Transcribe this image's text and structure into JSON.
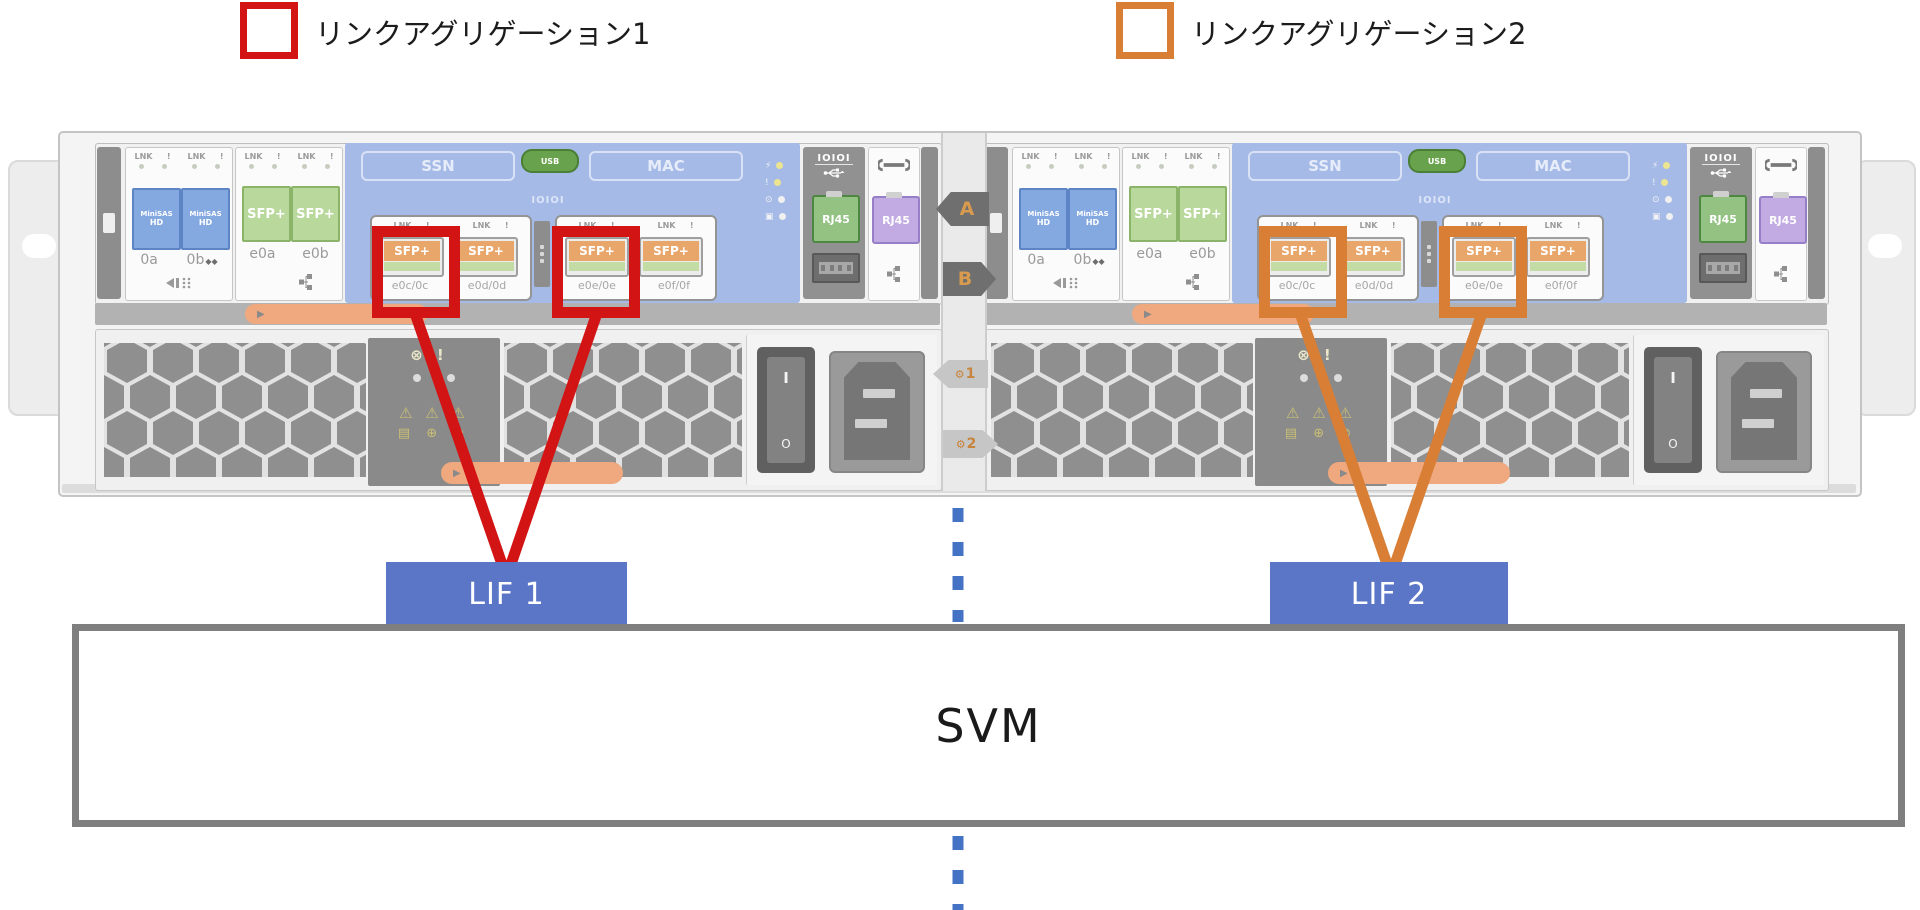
{
  "colors": {
    "link_aggregation_1": "#d21414",
    "link_aggregation_2": "#d97e35",
    "lif_box": "#5b76c7",
    "svm_border": "#7f7f7f",
    "dotted_line": "#4472c4"
  },
  "legend": {
    "items": [
      {
        "label": "リンクアグリゲーション1",
        "color": "#d21414"
      },
      {
        "label": "リンクアグリゲーション2",
        "color": "#d97e35"
      }
    ]
  },
  "chassis": {
    "divider_tags": {
      "top": "A",
      "bottom": "B",
      "gear_icon": "⚙",
      "psu1": "1",
      "psu2": "2"
    },
    "controllers": [
      {
        "link_label": "LNK",
        "attn_label": "!",
        "sas_module": {
          "card_label_top": "MiniSAS",
          "card_label_bottom": "HD",
          "ports": [
            "0a",
            "0b"
          ],
          "port_b_marker": "◆◆"
        },
        "onboard_module": {
          "card_label": "SFP+",
          "ports": [
            "e0a",
            "e0b"
          ]
        },
        "riser": {
          "ssn_label": "SSN",
          "usb_label": "USB",
          "mac_label": "MAC",
          "serial_label": "IOIOI",
          "sfp_label": "SFP+",
          "ports": [
            "e0c/0c",
            "e0d/0d",
            "e0e/0e",
            "e0f/0f"
          ],
          "led_icons": [
            "⚡",
            "!",
            "⊙",
            "▣"
          ]
        },
        "bmc_panel": {
          "serial_label": "IOIOI",
          "rj45_label": "RJ45"
        },
        "mgmt_panel": {
          "rj45_label": "RJ45"
        },
        "service_panel": {
          "cross_icon": "⊗",
          "attn_icon": "!",
          "warning_icons": "⚠ ⚠ ⚠",
          "info_icons": "▤ ⊕ ⊘"
        },
        "psu": {
          "switch_on": "I",
          "switch_off": "O"
        }
      },
      {
        "link_label": "LNK",
        "attn_label": "!",
        "sas_module": {
          "card_label_top": "MiniSAS",
          "card_label_bottom": "HD",
          "ports": [
            "0a",
            "0b"
          ],
          "port_b_marker": "◆◆"
        },
        "onboard_module": {
          "card_label": "SFP+",
          "ports": [
            "e0a",
            "e0b"
          ]
        },
        "riser": {
          "ssn_label": "SSN",
          "usb_label": "USB",
          "mac_label": "MAC",
          "serial_label": "IOIOI",
          "sfp_label": "SFP+",
          "ports": [
            "e0c/0c",
            "e0d/0d",
            "e0e/0e",
            "e0f/0f"
          ],
          "led_icons": [
            "⚡",
            "!",
            "⊙",
            "▣"
          ]
        },
        "bmc_panel": {
          "serial_label": "IOIOI",
          "rj45_label": "RJ45"
        },
        "mgmt_panel": {
          "rj45_label": "RJ45"
        },
        "service_panel": {
          "cross_icon": "⊗",
          "attn_icon": "!",
          "warning_icons": "⚠ ⚠ ⚠",
          "info_icons": "▤ ⊕ ⊘"
        },
        "psu": {
          "switch_on": "I",
          "switch_off": "O"
        }
      }
    ]
  },
  "diagram": {
    "lif1_label": "LIF 1",
    "lif2_label": "LIF 2",
    "svm_label": "SVM"
  }
}
